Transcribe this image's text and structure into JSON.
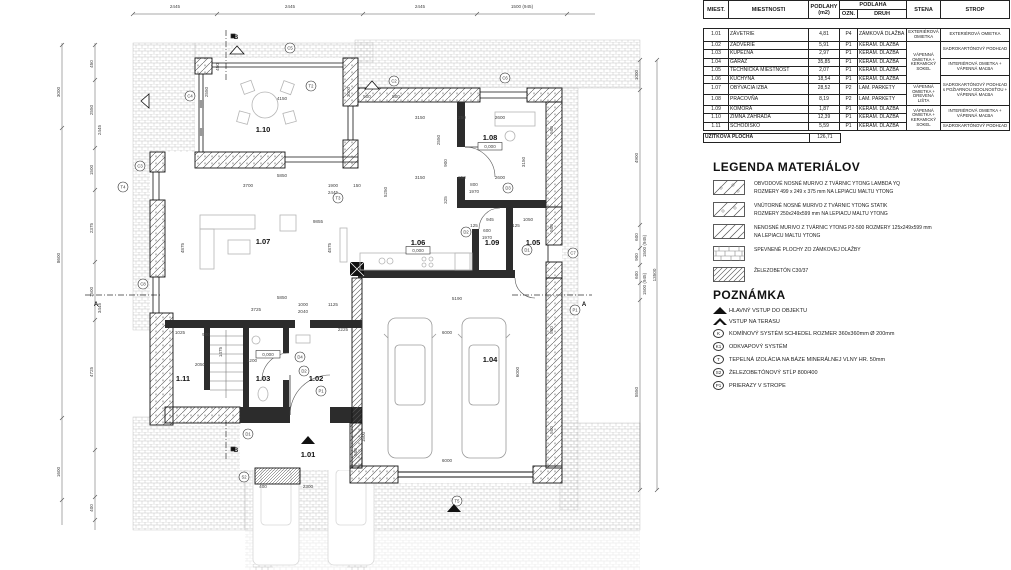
{
  "table": {
    "headers": {
      "miest": "MIEST.",
      "miestnosti": "MIESTNOSTI",
      "podlahy": "PODLAHY (m2)",
      "podlaha": "PODLAHA",
      "ozn": "OZN.",
      "druh": "DRUH",
      "stena": "STENA",
      "strop": "STROP"
    },
    "rows": [
      {
        "id": "1.01",
        "name": "ZÁVETRIE",
        "area": "4,81",
        "ozn": "P4",
        "druh": "ZÁMKOVÁ DLAŽBA"
      },
      {
        "id": "1.02",
        "name": "ZÁDVERIE",
        "area": "5,91",
        "ozn": "P1",
        "druh": "KERAM. DLAŽBA"
      },
      {
        "id": "1.03",
        "name": "KÚPEĽŇA",
        "area": "2,97",
        "ozn": "P1",
        "druh": "KERAM. DLAŽBA"
      },
      {
        "id": "1.04",
        "name": "GARÁŽ",
        "area": "35,85",
        "ozn": "P1",
        "druh": "KERAM. DLAŽBA"
      },
      {
        "id": "1.05",
        "name": "TECHNICKÁ MIESTNOSŤ",
        "area": "2,07",
        "ozn": "P1",
        "druh": "KERAM. DLAŽBA"
      },
      {
        "id": "1.06",
        "name": "KUCHYŇA",
        "area": "18,54",
        "ozn": "P1",
        "druh": "KERAM. DLAŽBA"
      },
      {
        "id": "1.07",
        "name": "OBÝVACIA IZBA",
        "area": "28,52",
        "ozn": "P2",
        "druh": "LAM. PARKETY"
      },
      {
        "id": "1.08",
        "name": "PRACOVŇA",
        "area": "8,19",
        "ozn": "P2",
        "druh": "LAM. PARKETY"
      },
      {
        "id": "1.09",
        "name": "KOMORA",
        "area": "1,87",
        "ozn": "P1",
        "druh": "KERAM. DLAŽBA"
      },
      {
        "id": "1.10",
        "name": "ZIMNÁ ZÁHRADA",
        "area": "12,39",
        "ozn": "P1",
        "druh": "KERAM. DLAŽBA"
      },
      {
        "id": "1.11",
        "name": "SCHODISKO",
        "area": "5,59",
        "ozn": "P1",
        "druh": "KERAM. DLAŽBA"
      }
    ],
    "stena_groups": [
      {
        "start": 0,
        "span": 1,
        "text": "EXTERIÉROVÁ OMIETKA"
      },
      {
        "start": 1,
        "span": 5,
        "text": "VÁPENNÁ OMIETKA + KERAMICKÝ SOKEL"
      },
      {
        "start": 6,
        "span": 2,
        "text": "VÁPENNÁ OMIETKA + DREVENÁ LIŠTA"
      },
      {
        "start": 8,
        "span": 3,
        "text": "VÁPENNÁ OMIETKA + KERAMICKÝ SOKEL"
      }
    ],
    "strop_groups": [
      {
        "start": 0,
        "span": 1,
        "text": "EXTERIÉROVÁ OMIETKA"
      },
      {
        "start": 1,
        "span": 2,
        "text": "SADROKARTÓNOVÝ PODHĽAD"
      },
      {
        "start": 3,
        "span": 2,
        "text": "INTERIÉROVÁ OMIETKA + VÁPENNÁ MAĽBA"
      },
      {
        "start": 5,
        "span": 3,
        "text": "SADROKARTÓNOVÝ PODHĽAD s POŽIARNOU ODOLNOSŤOU + VÁPENNÁ MAĽBA"
      },
      {
        "start": 8,
        "span": 2,
        "text": "INTERIÉROVÁ OMIETKA + VÁPENNÁ MAĽBA"
      },
      {
        "start": 10,
        "span": 1,
        "text": "SADROKARTÓNOVÝ PODHĽAD"
      }
    ],
    "total_label": "ÚŽITKOVÁ PLOCHA",
    "total_value": "126,71"
  },
  "legend": {
    "title": "LEGENDA MATERIÁLOV",
    "items": [
      {
        "swatch": "ytong-ext",
        "lines": [
          "OBVODOVÉ NOSNÉ MURIVO Z TVÁRNIC YTONG LAMBDA YQ",
          "ROZMERY 499 x 249 x 375 mm  NA LEPIACU MALTU YTONG"
        ]
      },
      {
        "swatch": "ytong-int",
        "lines": [
          "VNÚTORNÉ NOSNÉ MURIVO Z TVÁRNIC YTONG STATIK",
          "ROZMERY 250x249x599 mm NA LEPIACU MALTU YTONG"
        ]
      },
      {
        "swatch": "nonbearing",
        "lines": [
          "NENOSNÉ MURIVO Z TVÁRNIC YTONG P2-500 ROZMERY  125x249x599 mm",
          "NA LEPIACU MALTU YTONG"
        ]
      },
      {
        "swatch": "pavers",
        "lines": [
          "SPEVNENÉ PLOCHY ZO ZÁMKOVEJ DLAŽBY"
        ]
      },
      {
        "swatch": "concrete",
        "lines": [
          "ŽELEZOBETÓN C30/37"
        ]
      }
    ]
  },
  "notes": {
    "title": "POZNÁMKA",
    "items": [
      {
        "symbol": "triangle-filled",
        "text": "HLAVNÝ VSTUP DO OBJEKTU"
      },
      {
        "symbol": "triangle-outline",
        "text": "VSTUP NA TERASU"
      },
      {
        "symbol": "K",
        "text": "KOMÍNOVÝ SYSTÉM SCHIEDEL  ROZMER 360x360mm Ø 200mm"
      },
      {
        "symbol": "K1",
        "text": "ODKVAPOVÝ SYSTÉM"
      },
      {
        "symbol": "T",
        "text": "TEPELNÁ IZOLÁCIA NA BÁZE MINERÁLNEJ VLNY HR. 50mm"
      },
      {
        "symbol": "S2",
        "text": "ŽELEZOBETÓNOVÝ STĹP 800/400"
      },
      {
        "symbol": "P1",
        "text": "PRIERAZY V STROPE"
      }
    ]
  },
  "plan": {
    "rooms": [
      {
        "id": "1.10",
        "x": 263,
        "y": 132
      },
      {
        "id": "1.07",
        "x": 263,
        "y": 244
      },
      {
        "id": "1.08",
        "x": 490,
        "y": 140
      },
      {
        "id": "1.06",
        "x": 418,
        "y": 245
      },
      {
        "id": "1.09",
        "x": 492,
        "y": 245
      },
      {
        "id": "1.05",
        "x": 533,
        "y": 245
      },
      {
        "id": "1.11",
        "x": 183,
        "y": 381
      },
      {
        "id": "1.03",
        "x": 263,
        "y": 381
      },
      {
        "id": "1.02",
        "x": 316,
        "y": 381
      },
      {
        "id": "1.01",
        "x": 308,
        "y": 457
      },
      {
        "id": "1.04",
        "x": 490,
        "y": 362
      }
    ],
    "level_text": "0,000",
    "levels": [
      {
        "x": 418,
        "y": 252
      },
      {
        "x": 490,
        "y": 148
      },
      {
        "x": 268,
        "y": 356
      }
    ],
    "dims": [
      {
        "t": "2445",
        "x": 175,
        "y": 8
      },
      {
        "t": "2445",
        "x": 290,
        "y": 8
      },
      {
        "t": "2445",
        "x": 420,
        "y": 8
      },
      {
        "t": "1500 (945)",
        "x": 522,
        "y": 8
      },
      {
        "t": "3000",
        "x": 60,
        "y": 92,
        "r": 1
      },
      {
        "t": "8600",
        "x": 60,
        "y": 258,
        "r": 1
      },
      {
        "t": "1600",
        "x": 60,
        "y": 472,
        "r": 1
      },
      {
        "t": "450",
        "x": 93,
        "y": 64,
        "r": 1
      },
      {
        "t": "2550",
        "x": 93,
        "y": 110,
        "r": 1
      },
      {
        "t": "2445",
        "x": 101,
        "y": 130,
        "r": 1
      },
      {
        "t": "1500",
        "x": 93,
        "y": 170,
        "r": 1
      },
      {
        "t": "2375",
        "x": 93,
        "y": 228,
        "r": 1
      },
      {
        "t": "1500",
        "x": 93,
        "y": 292,
        "r": 1
      },
      {
        "t": "3445",
        "x": 101,
        "y": 308,
        "r": 1
      },
      {
        "t": "4725",
        "x": 93,
        "y": 372,
        "r": 1
      },
      {
        "t": "400",
        "x": 93,
        "y": 508,
        "r": 1
      },
      {
        "t": "1000",
        "x": 638,
        "y": 75,
        "r": 1
      },
      {
        "t": "4900",
        "x": 638,
        "y": 158,
        "r": 1
      },
      {
        "t": "600",
        "x": 638,
        "y": 237,
        "r": 1
      },
      {
        "t": "900",
        "x": 638,
        "y": 257,
        "r": 1
      },
      {
        "t": "600",
        "x": 638,
        "y": 275,
        "r": 1
      },
      {
        "t": "1500 (945)",
        "x": 646,
        "y": 246,
        "r": 1
      },
      {
        "t": "1500 (945)",
        "x": 646,
        "y": 284,
        "r": 1
      },
      {
        "t": "5550",
        "x": 638,
        "y": 392,
        "r": 1
      },
      {
        "t": "13500",
        "x": 656,
        "y": 275,
        "r": 1
      },
      {
        "t": "450",
        "x": 219,
        "y": 67,
        "r": 1
      },
      {
        "t": "2550",
        "x": 208,
        "y": 92,
        "r": 1
      },
      {
        "t": "4150",
        "x": 282,
        "y": 100
      },
      {
        "t": "3000",
        "x": 350,
        "y": 92,
        "r": 1
      },
      {
        "t": "500",
        "x": 367,
        "y": 98
      },
      {
        "t": "500",
        "x": 396,
        "y": 98
      },
      {
        "t": "5850",
        "x": 282,
        "y": 177
      },
      {
        "t": "3700",
        "x": 248,
        "y": 187
      },
      {
        "t": "1900",
        "x": 333,
        "y": 187
      },
      {
        "t": "2445",
        "x": 333,
        "y": 194
      },
      {
        "t": "150",
        "x": 357,
        "y": 187
      },
      {
        "t": "9855",
        "x": 318,
        "y": 223
      },
      {
        "t": "4875",
        "x": 184,
        "y": 248,
        "r": 1
      },
      {
        "t": "4875",
        "x": 331,
        "y": 248,
        "r": 1
      },
      {
        "t": "5850",
        "x": 282,
        "y": 299
      },
      {
        "t": "3150",
        "x": 420,
        "y": 119
      },
      {
        "t": "2600",
        "x": 500,
        "y": 119
      },
      {
        "t": "250",
        "x": 462,
        "y": 119
      },
      {
        "t": "3150",
        "x": 420,
        "y": 179
      },
      {
        "t": "2600",
        "x": 500,
        "y": 179
      },
      {
        "t": "250",
        "x": 462,
        "y": 179
      },
      {
        "t": "3150",
        "x": 525,
        "y": 162,
        "r": 1
      },
      {
        "t": "2550",
        "x": 440,
        "y": 140,
        "r": 1
      },
      {
        "t": "5250",
        "x": 387,
        "y": 192,
        "r": 1
      },
      {
        "t": "900",
        "x": 447,
        "y": 163,
        "r": 1
      },
      {
        "t": "325",
        "x": 447,
        "y": 200,
        "r": 1
      },
      {
        "t": "800",
        "x": 474,
        "y": 186
      },
      {
        "t": "1970",
        "x": 474,
        "y": 193
      },
      {
        "t": "600",
        "x": 487,
        "y": 232
      },
      {
        "t": "1970",
        "x": 487,
        "y": 239
      },
      {
        "t": "945",
        "x": 490,
        "y": 221
      },
      {
        "t": "1050",
        "x": 528,
        "y": 221
      },
      {
        "t": "125",
        "x": 474,
        "y": 227
      },
      {
        "t": "125",
        "x": 516,
        "y": 227
      },
      {
        "t": "5190",
        "x": 457,
        "y": 300
      },
      {
        "t": "6000",
        "x": 447,
        "y": 334
      },
      {
        "t": "6000",
        "x": 519,
        "y": 372,
        "r": 1
      },
      {
        "t": "6000",
        "x": 447,
        "y": 462
      },
      {
        "t": "3725",
        "x": 256,
        "y": 311
      },
      {
        "t": "1000",
        "x": 303,
        "y": 306
      },
      {
        "t": "2040",
        "x": 303,
        "y": 313
      },
      {
        "t": "1125",
        "x": 333,
        "y": 306
      },
      {
        "t": "2225",
        "x": 343,
        "y": 331
      },
      {
        "t": "1025",
        "x": 180,
        "y": 334
      },
      {
        "t": "900",
        "x": 206,
        "y": 336
      },
      {
        "t": "2050",
        "x": 200,
        "y": 366
      },
      {
        "t": "1200",
        "x": 252,
        "y": 362
      },
      {
        "t": "1475",
        "x": 222,
        "y": 352,
        "r": 1
      },
      {
        "t": "400",
        "x": 263,
        "y": 488
      },
      {
        "t": "2300",
        "x": 308,
        "y": 488
      },
      {
        "t": "500",
        "x": 357,
        "y": 452,
        "r": 1
      },
      {
        "t": "1500",
        "x": 365,
        "y": 437,
        "r": 1
      },
      {
        "t": "500",
        "x": 553,
        "y": 130,
        "r": 1
      },
      {
        "t": "500",
        "x": 553,
        "y": 228,
        "r": 1
      },
      {
        "t": "500",
        "x": 553,
        "y": 330,
        "r": 1
      },
      {
        "t": "500",
        "x": 553,
        "y": 430,
        "r": 1
      }
    ],
    "markers": [
      {
        "x": 290,
        "y": 48,
        "t": "C5"
      },
      {
        "x": 190,
        "y": 96,
        "t": "C4"
      },
      {
        "x": 140,
        "y": 166,
        "t": "C3"
      },
      {
        "x": 123,
        "y": 187,
        "t": "T4"
      },
      {
        "x": 143,
        "y": 284,
        "t": "C8"
      },
      {
        "x": 394,
        "y": 81,
        "t": "C2"
      },
      {
        "x": 311,
        "y": 86,
        "t": "T2"
      },
      {
        "x": 338,
        "y": 198,
        "t": "T3"
      },
      {
        "x": 505,
        "y": 78,
        "t": "C6"
      },
      {
        "x": 573,
        "y": 253,
        "t": "C7"
      },
      {
        "x": 457,
        "y": 501,
        "t": "T5"
      },
      {
        "x": 248,
        "y": 434,
        "t": "D1"
      },
      {
        "x": 244,
        "y": 477,
        "t": "S2"
      },
      {
        "x": 321,
        "y": 391,
        "t": "P1"
      },
      {
        "x": 575,
        "y": 310,
        "t": "P1"
      },
      {
        "x": 300,
        "y": 357,
        "t": "D4"
      },
      {
        "x": 304,
        "y": 371,
        "t": "D2"
      },
      {
        "x": 508,
        "y": 188,
        "t": "D3"
      },
      {
        "x": 466,
        "y": 232,
        "t": "D2"
      },
      {
        "x": 527,
        "y": 250,
        "t": "D1"
      }
    ],
    "triangles_filled": [
      {
        "x": 308,
        "y": 441
      },
      {
        "x": 454,
        "y": 509
      }
    ],
    "triangles_outline": [
      {
        "x": 237,
        "y": 51,
        "r": 0
      },
      {
        "x": 372,
        "y": 86,
        "r": 0
      },
      {
        "x": 146,
        "y": 101,
        "r": -90
      }
    ],
    "section_labels": [
      {
        "x": 96,
        "y": 306,
        "t": "A"
      },
      {
        "x": 584,
        "y": 306,
        "t": "A"
      },
      {
        "x": 236,
        "y": 39,
        "t": "B"
      },
      {
        "x": 236,
        "y": 452,
        "t": "B"
      }
    ]
  },
  "colors": {
    "line": "#1a1a1a",
    "dim": "#444",
    "paver": "#c4c4c4",
    "hatch": "#555",
    "furniture": "#b5b5b5",
    "faint": "#d8d8d8"
  }
}
